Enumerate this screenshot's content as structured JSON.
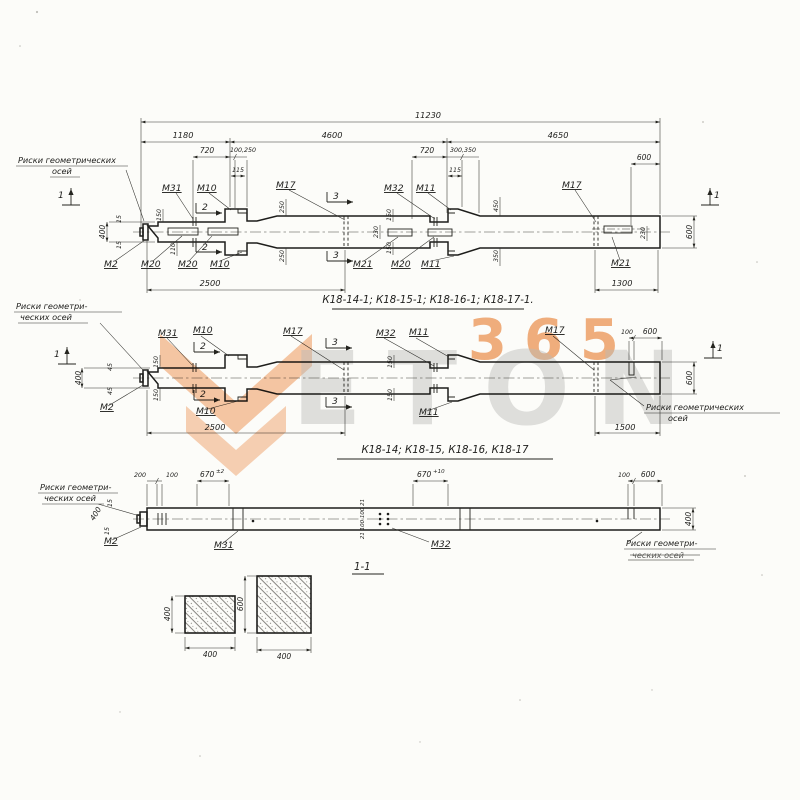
{
  "labels": {
    "m2": "М2",
    "m10": "М10",
    "m11": "М11",
    "m17": "М17",
    "m20": "М20",
    "m21": "М21",
    "m31": "М31",
    "m32": "М32",
    "f1": "1",
    "f2": "2",
    "f3": "3",
    "note_geom_full_1": "Риски геометрических",
    "note_geom_full_2": "осей",
    "note_geom_hyph_1": "Риски геометри-",
    "note_geom_hyph_2": "ческих осей"
  },
  "d1": {
    "title": "К18-14-1; К18-15-1; К18-16-1; К18-17-1.",
    "dims": {
      "total": "11230",
      "seg1": "1180",
      "seg2": "4600",
      "seg3": "4650",
      "a720": "720",
      "a100_250": "100,250",
      "a115": "115",
      "a300_350": "300,350",
      "a600": "600",
      "v400": "400",
      "v15": "15",
      "v150": "150",
      "v110": "110",
      "v250": "250",
      "v230": "230",
      "v450": "450",
      "v350": "350",
      "base_left": "2500",
      "base_right": "1300",
      "h600": "600"
    }
  },
  "d2": {
    "title": "К18-14; К18-15, К18-16, К18-17",
    "dims": {
      "v400": "400",
      "v45": "45",
      "v150": "150",
      "a100": "100",
      "a600": "600",
      "base_left": "2500",
      "base_right": "1500",
      "h600": "600"
    }
  },
  "d3": {
    "section_label": "1-1",
    "dims": {
      "a200": "200",
      "a100": "100",
      "a670_base": "670",
      "a670a_tol": "±2",
      "a670b_tol": "+10",
      "a100r": "100",
      "a600r": "600",
      "v400": "400",
      "v15": "15",
      "stack": "21 100 100 21",
      "h400": "400"
    }
  },
  "sections": {
    "s1": {
      "w": "400",
      "h": "400"
    },
    "s2": {
      "w": "400",
      "h": "600"
    }
  },
  "watermark": {
    "number": "365",
    "word": "ETON"
  }
}
